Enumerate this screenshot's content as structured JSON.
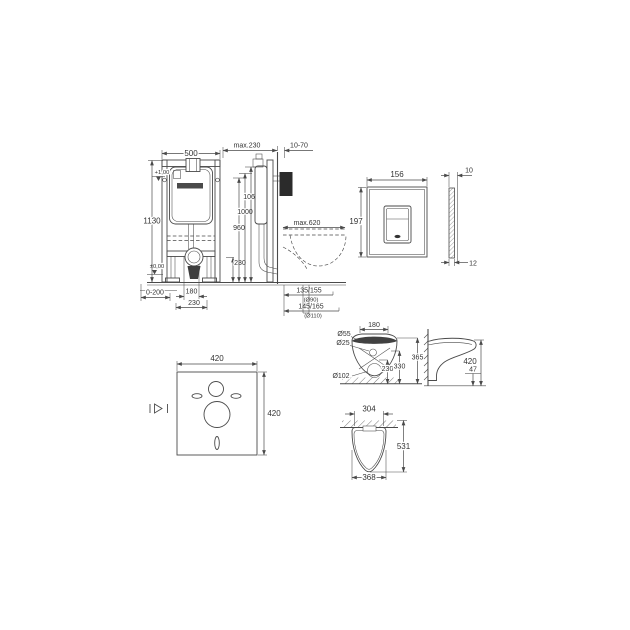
{
  "drawing": {
    "title": "wc-installation-dimensional-drawing",
    "colors": {
      "background": "#ffffff",
      "line": "#4a4a4a",
      "text": "#333333",
      "dark_fill": "#2b2b2b"
    },
    "frame_front": {
      "width": "500",
      "height": "1130",
      "level_upper": "+1,00",
      "level_floor": "±0,00",
      "feet_range": "0-200",
      "rod_spacing": "180",
      "outlet_offset": "230"
    },
    "frame_side": {
      "top_clearance": "max.230",
      "wall_thickness": "10-70",
      "outlet_height": "230",
      "height_960": "960",
      "height_1000": "1000",
      "height_1060": "1060",
      "depth_max": "max.620",
      "drain_height_a": "135/155",
      "drain_note_a": "(Ø90)",
      "drain_height_b": "145/165",
      "drain_note_b": "(Ø110)"
    },
    "flush_plate": {
      "width": "156",
      "height": "197",
      "thickness_top": "10",
      "thickness_bottom": "12"
    },
    "sound_mat": {
      "width": "420",
      "height": "420"
    },
    "wc_back": {
      "hole_seat": "Ø55",
      "hole_small": "Ø25",
      "hole_outlet": "Ø102",
      "bolt_spacing": "180",
      "height_outlet": "230",
      "height_330": "330",
      "height_365": "365"
    },
    "wc_side": {
      "height": "420",
      "clearance": "47"
    },
    "wc_top": {
      "fixing_width": "304",
      "depth": "531",
      "bowl_width": "368"
    }
  }
}
